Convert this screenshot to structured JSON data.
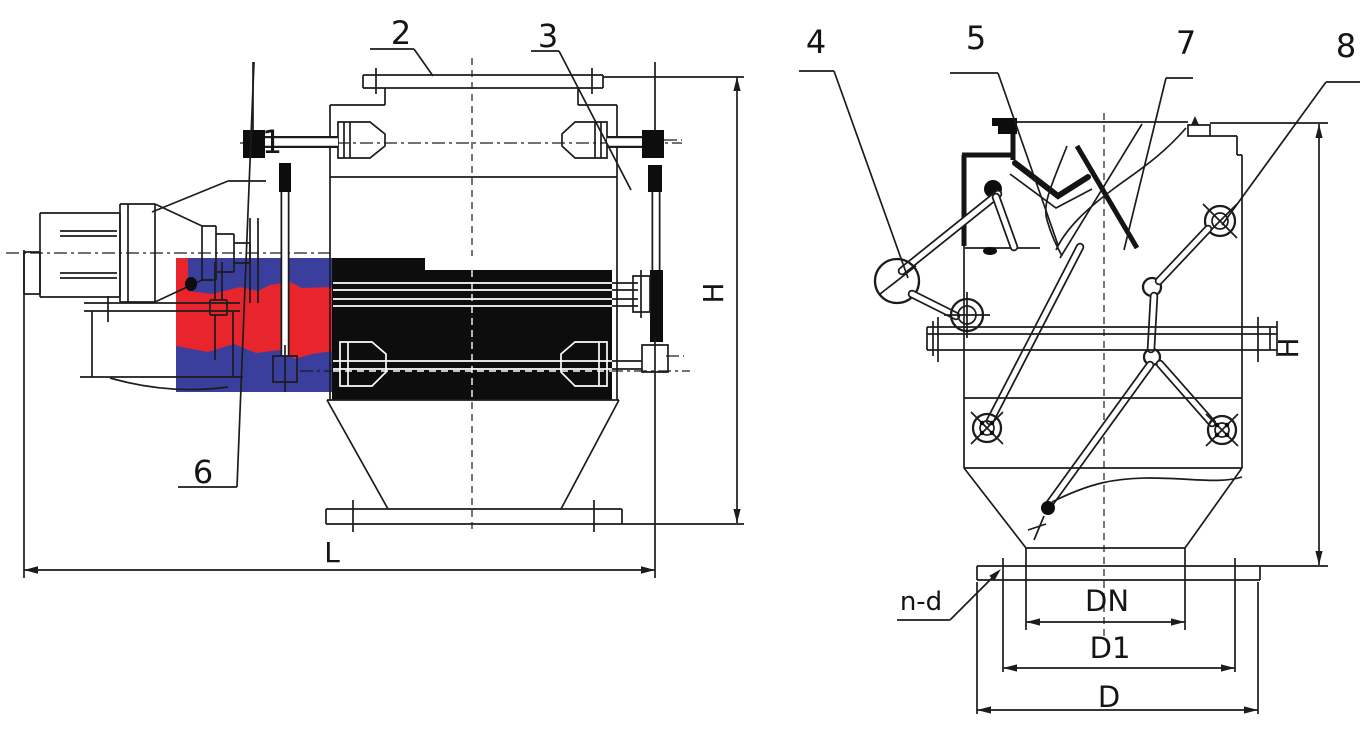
{
  "labels": {
    "callouts": {
      "c1": "1",
      "c2": "2",
      "c3": "3",
      "c4": "4",
      "c5": "5",
      "c6": "6",
      "c7": "7",
      "c8": "8"
    },
    "dimensions": {
      "length": "L",
      "height": "H",
      "outlet_bore": "DN",
      "bolt_circle": "D1",
      "flange_od": "D",
      "bolt_holes": "n-d"
    }
  },
  "colors": {
    "line": "#1c1c1c",
    "solid_fill": "#0d0d0d",
    "highlight_red": "#e8252d",
    "highlight_blue": "#3a3f9e",
    "background": "#ffffff"
  }
}
